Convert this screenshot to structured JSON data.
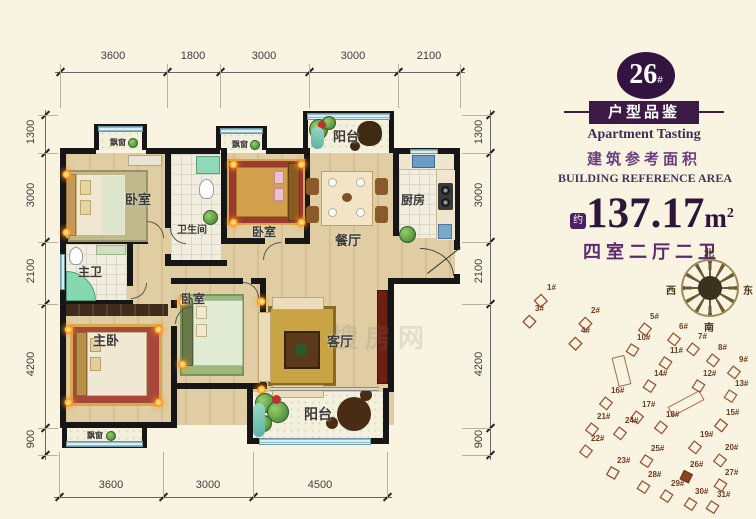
{
  "colors": {
    "background": "#f9f4e2",
    "wall": "#161616",
    "accent_purple": "#3b1b46",
    "text_purple": "#5c2a6e",
    "site_outline": "#9c5232",
    "highlight_building": "#8a4520"
  },
  "dimensions": {
    "top": [
      "3600",
      "1800",
      "3000",
      "3000",
      "2100"
    ],
    "bottom": [
      "3600",
      "3000",
      "4500"
    ],
    "left": [
      "1300",
      "3000",
      "2100",
      "4200",
      "900"
    ],
    "right": [
      "1300",
      "3000",
      "2100",
      "4200",
      "900"
    ]
  },
  "rooms": {
    "bedroom_tl": "卧室",
    "bathroom": "卫生间",
    "bedroom_tc": "卧室",
    "balcony_top": "阳台",
    "kitchen": "厨房",
    "dining": "餐厅",
    "master_bath": "主卫",
    "master_bedroom": "主卧",
    "bedroom_bc": "卧室",
    "living": "客厅",
    "balcony_bottom": "阳台",
    "bay_window": "飘窗"
  },
  "info_panel": {
    "building_number": "26",
    "building_number_suffix": "#",
    "title_cn": "户型品鉴",
    "title_en": "Apartment Tasting",
    "area_label_cn": "建筑参考面积",
    "area_label_en": "BUILDING REFERENCE AREA",
    "area_prefix": "约",
    "area_value": "137.17",
    "area_unit_base": "m",
    "area_unit_sup": "2",
    "layout_desc": "四室二厅二卫"
  },
  "compass": {
    "north": "北",
    "south": "南",
    "east": "东",
    "west": "西"
  },
  "watermark": "搜房网",
  "site_plan": {
    "highlighted": "26#",
    "buildings": [
      {
        "label": "1#",
        "x": 40,
        "y": 12,
        "r": 30,
        "n": 4
      },
      {
        "label": "2#",
        "x": 84,
        "y": 35,
        "r": 25,
        "n": 4
      },
      {
        "label": "3#",
        "x": 28,
        "y": 33,
        "r": 25,
        "n": 5
      },
      {
        "label": "4#",
        "x": 74,
        "y": 55,
        "r": 25,
        "n": 5
      },
      {
        "label": "5#",
        "x": 143,
        "y": 41,
        "r": 20,
        "n": 3
      },
      {
        "label": "6#",
        "x": 172,
        "y": 51,
        "r": 20,
        "n": 3
      },
      {
        "label": "7#",
        "x": 191,
        "y": 61,
        "r": 20,
        "n": 3
      },
      {
        "label": "8#",
        "x": 211,
        "y": 72,
        "r": 20,
        "n": 3
      },
      {
        "label": "9#",
        "x": 232,
        "y": 84,
        "r": 20,
        "n": 3
      },
      {
        "label": "10#",
        "x": 130,
        "y": 62,
        "r": 15,
        "n": 3
      },
      {
        "label": "11#",
        "x": 163,
        "y": 75,
        "r": 15,
        "n": 3
      },
      {
        "label": "12#",
        "x": 196,
        "y": 98,
        "r": 15,
        "n": 3
      },
      {
        "label": "13#",
        "x": 228,
        "y": 108,
        "r": 15,
        "n": 2
      },
      {
        "label": "14#",
        "x": 147,
        "y": 98,
        "r": 15,
        "n": 3
      },
      {
        "label": "15#",
        "x": 219,
        "y": 137,
        "r": 20,
        "n": 5
      },
      {
        "label": "16#",
        "x": 104,
        "y": 115,
        "r": 20,
        "n": 3
      },
      {
        "label": "17#",
        "x": 135,
        "y": 129,
        "r": 20,
        "n": 3
      },
      {
        "label": "18#",
        "x": 159,
        "y": 139,
        "r": 20,
        "n": 3
      },
      {
        "label": "19#",
        "x": 193,
        "y": 159,
        "r": 20,
        "n": 3
      },
      {
        "label": "20#",
        "x": 218,
        "y": 172,
        "r": 20,
        "n": 3
      },
      {
        "label": "21#",
        "x": 90,
        "y": 141,
        "r": 20,
        "n": 3
      },
      {
        "label": "22#",
        "x": 84,
        "y": 163,
        "r": 20,
        "n": 3
      },
      {
        "label": "23#",
        "x": 110,
        "y": 185,
        "r": 12,
        "n": 5
      },
      {
        "label": "24#",
        "x": 118,
        "y": 145,
        "r": 20,
        "n": 3
      },
      {
        "label": "25#",
        "x": 144,
        "y": 173,
        "r": 15,
        "n": 3
      },
      {
        "label": "26#",
        "x": 183,
        "y": 189,
        "r": 8,
        "n": 3,
        "hl": true
      },
      {
        "label": "27#",
        "x": 218,
        "y": 197,
        "r": 15,
        "n": 3
      },
      {
        "label": "28#",
        "x": 141,
        "y": 199,
        "r": 15,
        "n": 3
      },
      {
        "label": "29#",
        "x": 164,
        "y": 208,
        "r": 15,
        "n": 3
      },
      {
        "label": "30#",
        "x": 188,
        "y": 216,
        "r": 15,
        "n": 3
      },
      {
        "label": "31#",
        "x": 210,
        "y": 219,
        "r": 15,
        "n": 3
      }
    ]
  }
}
